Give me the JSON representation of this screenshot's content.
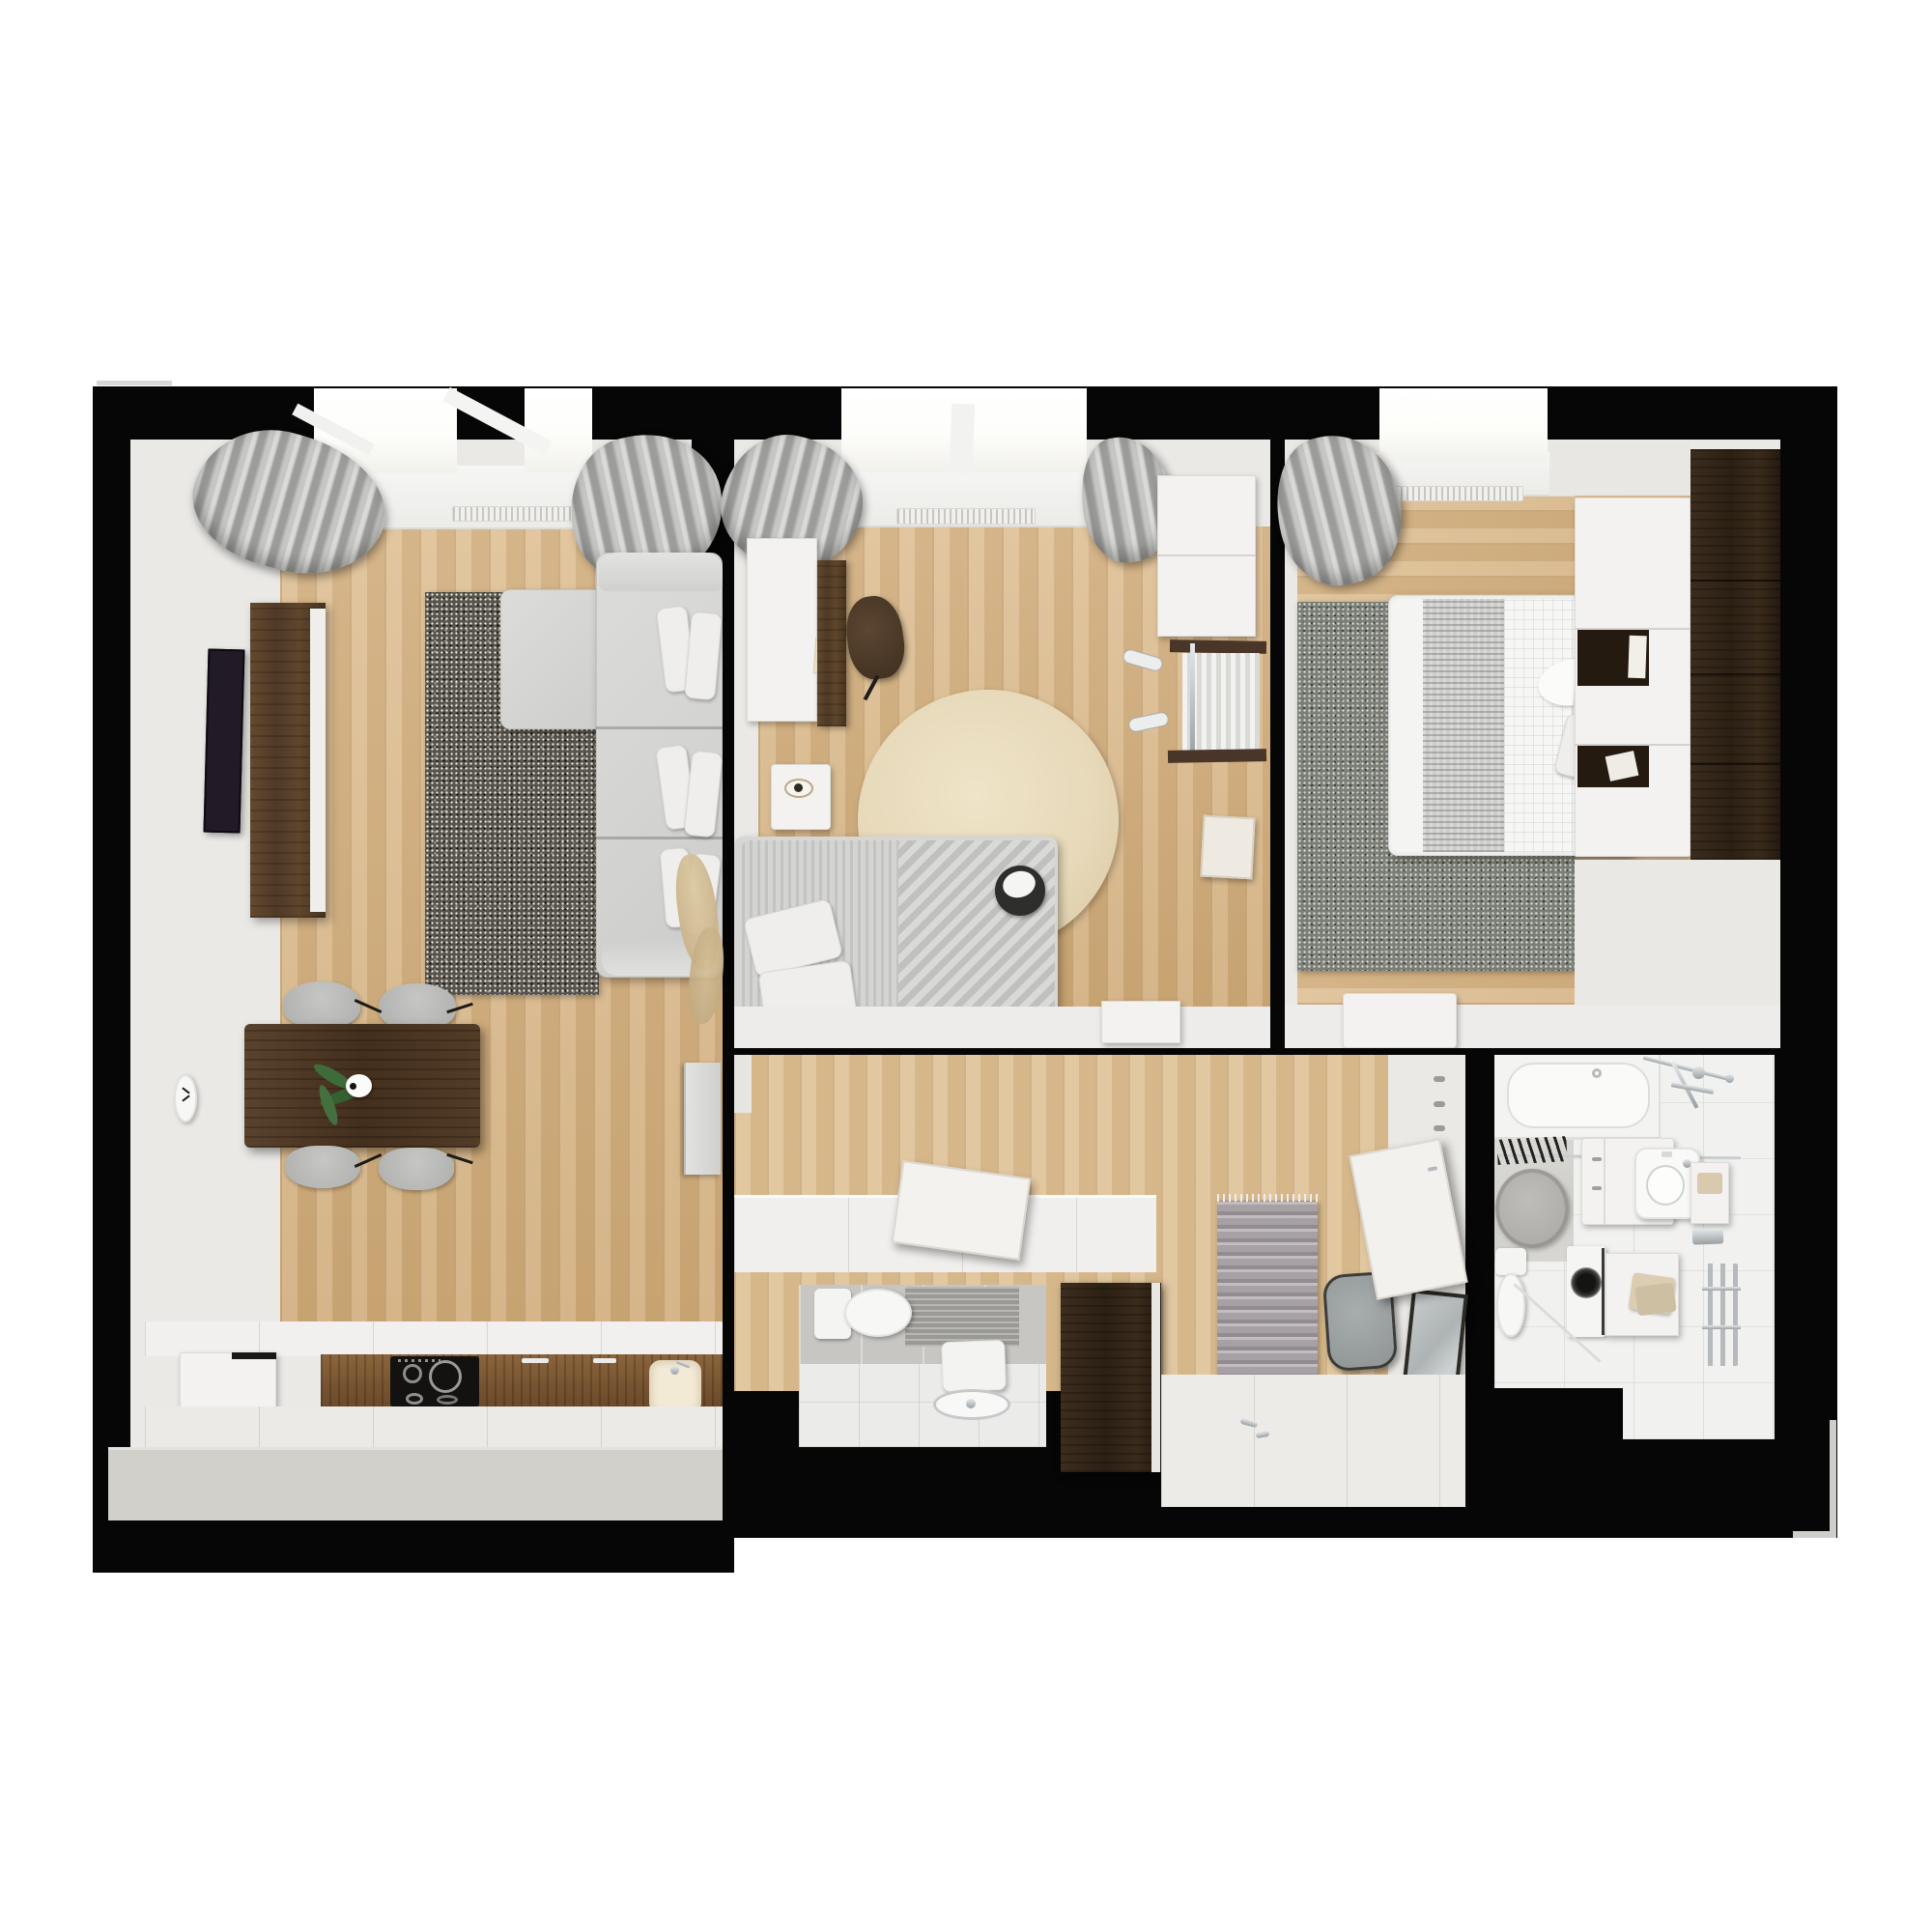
{
  "meta": {
    "title": "Top-down 3D render of a two-bedroom apartment floor plan",
    "view": "orthographic top-down architectural visualization",
    "visible_text": "none"
  },
  "palette": {
    "wall": "#060606",
    "wall_white": "#eae9e6",
    "floor_white": "#edecea",
    "floor_wood": "#d9b583",
    "window_glow": "#fdfdfa",
    "curtain_gray": "#a9a9a7",
    "rug_dark": "#57534d",
    "rug_bedroom": "#7b7e76",
    "rug_round_beige": "#e7d9ba",
    "rug_hall": "#a7a0a4",
    "sofa": "#d4d4d2",
    "pillow": "#efeeec",
    "walnut": "#5a4330",
    "walnut_dark": "#2c2014",
    "kitchen_front": "#7b5835",
    "cooktop": "#141210",
    "tv": "#221a26",
    "plant_green": "#3f6b3a",
    "cream": "#f3ead6",
    "chrome": "#b9bcbe",
    "tile_gray": "#c7c6c2",
    "platform_gray": "#d2d0cb"
  },
  "rooms": [
    {
      "id": "living-kitchen",
      "name": "open living room with kitchen and dining area"
    },
    {
      "id": "kids-bedroom",
      "name": "small bedroom with desk, round rug and single bed"
    },
    {
      "id": "master-bedroom",
      "name": "bedroom with double bed, gray rug and wardrobes"
    },
    {
      "id": "hallway",
      "name": "entry hall with wardrobe, runner rug, pouf and mirror"
    },
    {
      "id": "wc",
      "name": "guest toilet with washbasin"
    },
    {
      "id": "bathroom",
      "name": "bathroom with tub, vanity, toilet, washing machine and towel radiator"
    }
  ],
  "furniture": {
    "living-kitchen": [
      "corner-sofa",
      "chaise",
      "speckled-rug",
      "wall-tv",
      "walnut-sideboard",
      "dining-table",
      "dining-chairs-x4",
      "plant-in-vase",
      "wall-clock",
      "pampas-decor",
      "fridge",
      "kitchen-counter",
      "induction-cooktop",
      "kitchen-sink",
      "radiator",
      "curtains",
      "window"
    ],
    "kids-bedroom": [
      "desk",
      "desk-cabinet",
      "desk-chair",
      "nightstand",
      "round-beige-rug",
      "single-bed",
      "striped-duvet",
      "panda-plush",
      "wall-cabinet",
      "open-clothes-rack",
      "wall-lamps",
      "leaning-board",
      "radiator",
      "curtains",
      "window"
    ],
    "master-bedroom": [
      "double-bed",
      "knit-throw",
      "pillows",
      "speckled-rug",
      "headboard-wardrobe",
      "dark-wardrobe",
      "bench",
      "radiator",
      "curtain",
      "window"
    ],
    "hallway": [
      "wardrobe-counter",
      "open-flap-door",
      "entry-cabinet-dark",
      "runner-rug",
      "pouf",
      "leaning-mirror",
      "coat-hooks",
      "open-bathroom-door"
    ],
    "wc": [
      "toilet",
      "washbasin",
      "towel",
      "gray-wall-tiles"
    ],
    "bathroom": [
      "bathtub",
      "shower-fixture",
      "round-rug",
      "vanity-cabinet",
      "countertop-sink",
      "wall-shelf",
      "toilet",
      "washing-machine",
      "towel-box",
      "towel-radiator",
      "hanging-towels"
    ]
  }
}
